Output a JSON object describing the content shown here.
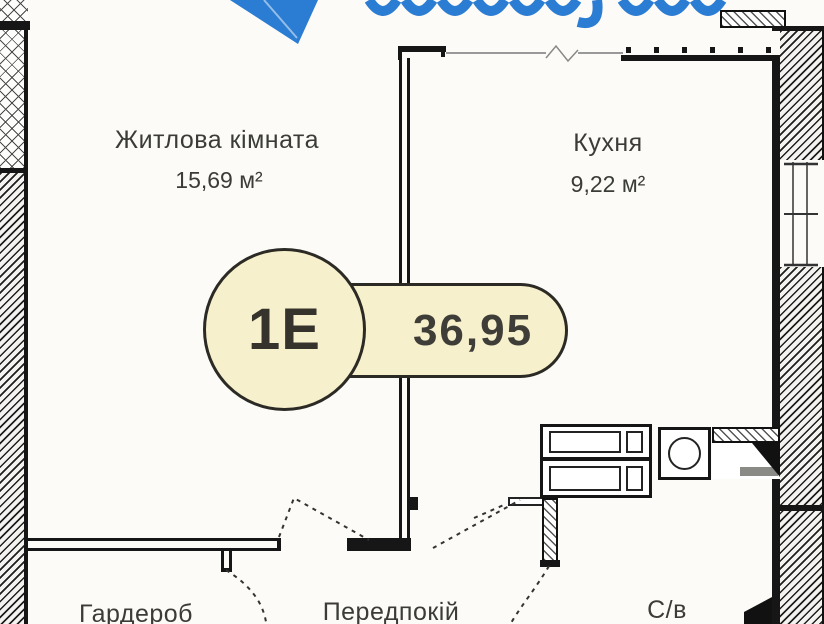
{
  "page": {
    "type": "apartment-floor-plan",
    "background": "#fcfbf7"
  },
  "logo": {
    "description": "partial blue paper-plane logo with wordmark cut off at top",
    "color": "#2b7cd3"
  },
  "badge": {
    "unit": "1Е",
    "area": "36,95",
    "fill": "#f7f0cc",
    "border": "#2c2a24"
  },
  "rooms": {
    "living": {
      "name": "Житлова кімната",
      "area": "15,69 м²"
    },
    "kitchen": {
      "name": "Кухня",
      "area": "9,22 м²"
    },
    "wardrobe": {
      "name": "Гардероб"
    },
    "hallway": {
      "name": "Передпокій"
    },
    "bathroom": {
      "name": "С/в"
    }
  },
  "colors": {
    "wall": "#161616",
    "label_text": "#3b3b38",
    "thin_window_line": "#999999",
    "door_sill": "#8a8a86",
    "logo_blue": "#2b7cd3"
  }
}
